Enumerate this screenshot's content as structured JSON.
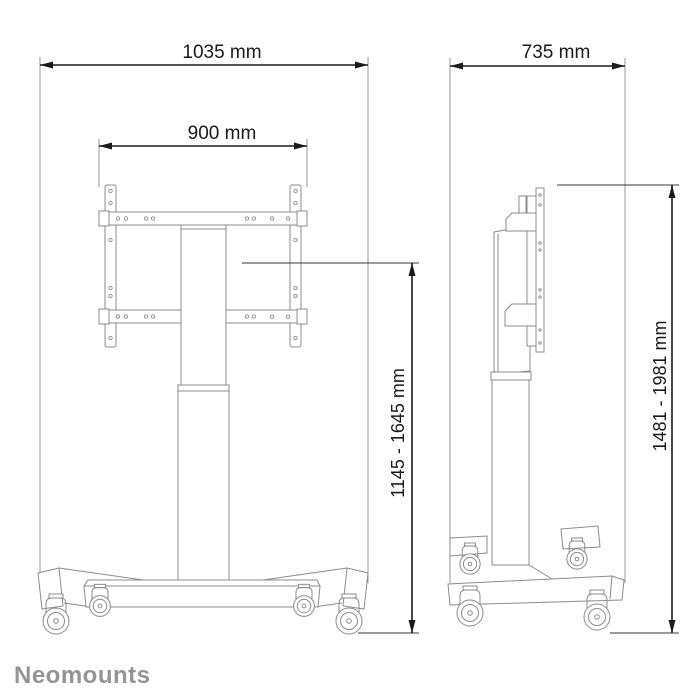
{
  "brand": {
    "logo_text": "Neomounts"
  },
  "diagram": {
    "front_view": {
      "total_width_label": "1035 mm",
      "mount_width_label": "900 mm",
      "height_range_label": "1145 - 1645 mm"
    },
    "side_view": {
      "depth_label": "735 mm",
      "height_range_label": "1481 - 1981 mm"
    }
  },
  "colors": {
    "product_line": "#8c8c8c",
    "dimension": "#1a1a1a",
    "extension_line": "#9a9a9a",
    "logo": "#949494",
    "background": "#ffffff"
  }
}
